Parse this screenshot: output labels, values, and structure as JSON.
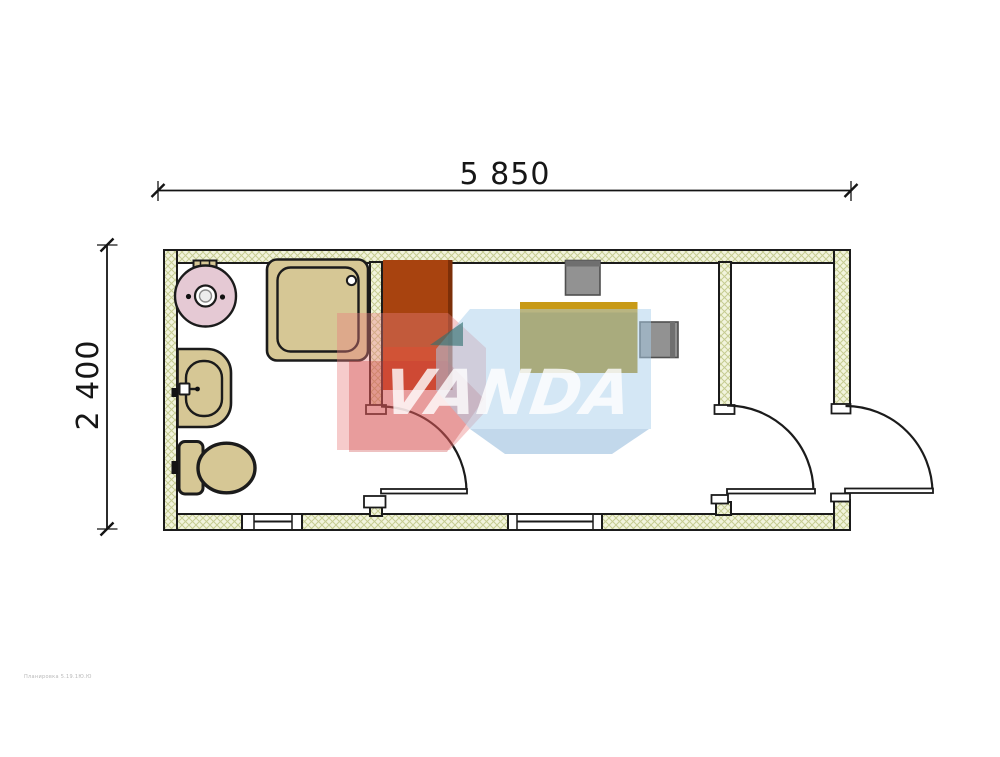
{
  "dimension_labels": {
    "width": "5 850",
    "height": "2 400"
  },
  "watermark": {
    "text": "VANDA",
    "caption": "Планировка 5.19.1Ю.Ю"
  },
  "colors": {
    "line": "#1b1b1b",
    "wall_fill": "#f2f4dd",
    "wall_hatch": "#c6cc92",
    "fixture_fill": "#d6c795",
    "boiler_fill": "#e5c9d4",
    "cabinet_top": "#a8430f",
    "cabinet_bottom": "#c23708",
    "cabinet_edge": "#7c2f08",
    "desk_body": "#a8860e",
    "desk_top": "#c89a16",
    "chair_fill": "#929292",
    "chair_dark": "#6f6f6f",
    "chair_border": "#4f4f4f",
    "watermark_pink": "#e87d7d",
    "watermark_red": "#c83232",
    "watermark_blue": "#a9d0ec",
    "watermark_blue_dark": "#86b2d8",
    "watermark_teal": "#2e6f6f"
  },
  "plan": {
    "overall_width_mm": "5 850",
    "overall_depth_mm": "2 400",
    "rooms": [
      {
        "name": "bathroom",
        "fixtures": [
          "water-heater",
          "shower-tray",
          "washbasin",
          "toilet",
          "window"
        ]
      },
      {
        "name": "office",
        "fixtures": [
          "wardrobe",
          "desk",
          "chair",
          "chair",
          "window",
          "door"
        ]
      },
      {
        "name": "entry",
        "fixtures": [
          "exterior-door"
        ]
      }
    ]
  }
}
